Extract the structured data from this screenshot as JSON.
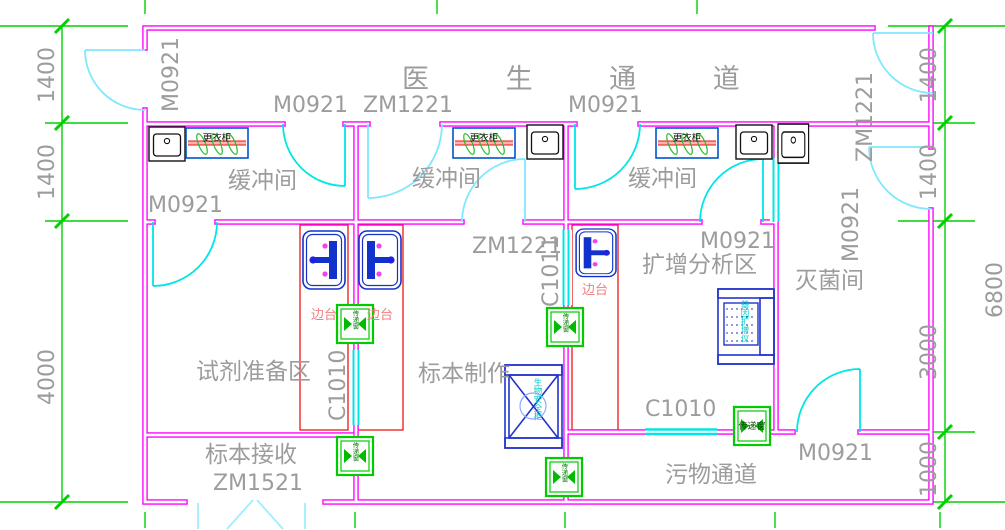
{
  "labels": {
    "corridor_doctor": "医 生 通 道",
    "buffer_room": "缓冲间",
    "reagent_room": "试剂准备区",
    "specimen_room": "标本制作",
    "amplification_room": "扩增分析区",
    "sterilization_room": "灭菌间",
    "receiving_room": "标本接收",
    "waste_corridor": "污物通道",
    "wardrobe": "更衣柜",
    "side_bench": "边台",
    "pass_window": "传递窗",
    "bsc_equipment": "生物安全柜",
    "pcr_equipment": "基因扩增仪"
  },
  "doors": {
    "left_exit": "M0921",
    "buffer1_entry": "M0921",
    "buffer2_entry": "ZM1221",
    "buffer3_entry": "M0921",
    "right_exit_top": "ZM1221",
    "sterilization_entry": "M0921",
    "buffer1_lab": "M0921",
    "buffer2_lab": "ZM1221",
    "amplification_entry": "M0921",
    "receiving_entry": "ZM1521",
    "waste_side": "M0921"
  },
  "windows": {
    "c1011": "C1011",
    "c1010_left": "C1010",
    "c1010_bottom": "C1010"
  },
  "dimensions": {
    "left": [
      "1400",
      "1400",
      "4000"
    ],
    "right": [
      "1400",
      "1400",
      "3000",
      "1000"
    ],
    "overall": "6800"
  }
}
